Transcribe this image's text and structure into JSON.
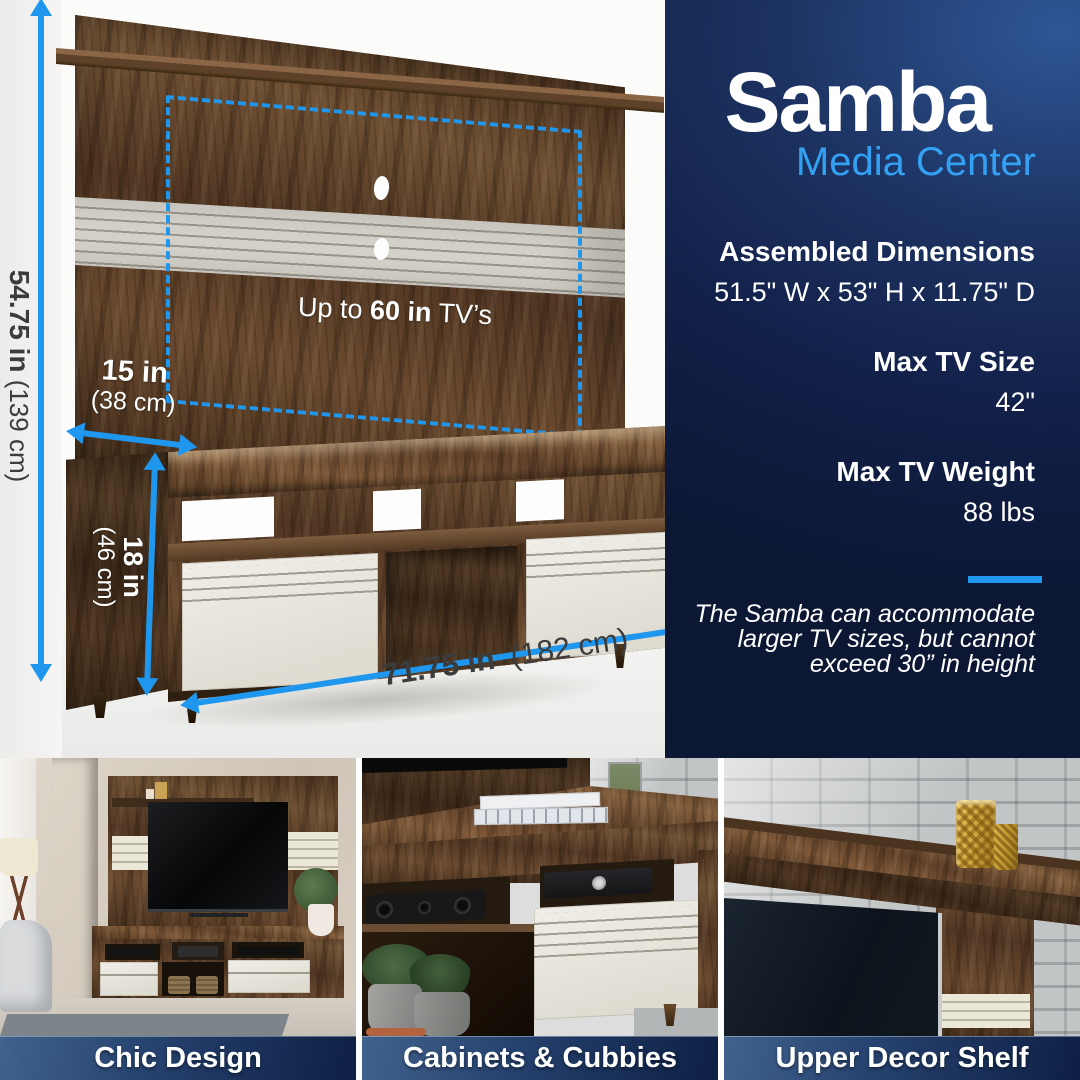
{
  "palette": {
    "accent": "#1f97ef",
    "subtitle_blue": "#33a1f3",
    "navy": "#0c1733",
    "label_gray": "#3c3c3c"
  },
  "hero": {
    "title": "Samba",
    "subtitle": "Media Center",
    "specs": [
      {
        "label": "Assembled Dimensions",
        "value": "51.5\" W x 53\" H x 11.75\" D"
      },
      {
        "label": "Max TV Size",
        "value": "42\""
      },
      {
        "label": "Max TV Weight",
        "value": "88 lbs"
      }
    ],
    "note_line1": "The Samba can accommodate",
    "note_line2": "larger TV sizes, but cannot",
    "note_line3": "exceed 30” in height"
  },
  "diagram": {
    "tv_capacity": {
      "prefix": "Up to ",
      "bold": "60 in",
      "suffix": " TV’s"
    },
    "overall_height": {
      "inches": "54.75 in",
      "cm": "(139 cm)"
    },
    "top_depth": {
      "inches": "15 in",
      "cm": "(38 cm)"
    },
    "stand_height": {
      "inches": "18 in",
      "cm": "(46 cm)"
    },
    "overall_width": {
      "inches": "71.75 in",
      "cm": "(182 cm)"
    }
  },
  "features": [
    {
      "caption": "Chic Design"
    },
    {
      "caption": "Cabinets & Cubbies"
    },
    {
      "caption": "Upper Decor Shelf"
    }
  ]
}
